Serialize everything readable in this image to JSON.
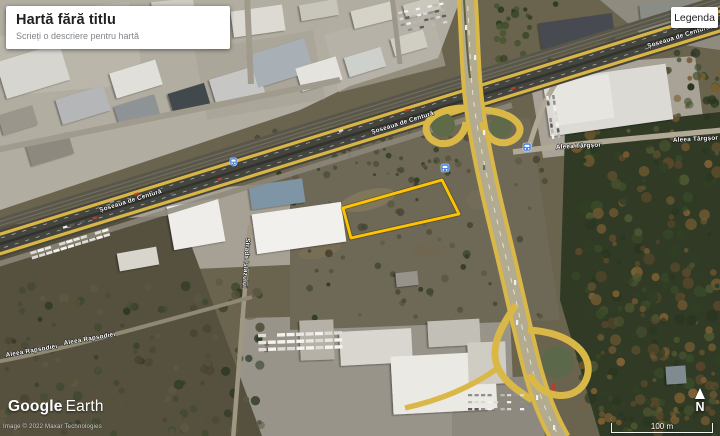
{
  "ui": {
    "map_card": {
      "title": "Hartă fără titlu",
      "subtitle": "Scrieți o descriere pentru hartă"
    },
    "legend_button": {
      "label": "Legenda"
    },
    "branding": {
      "logo_google": "Google",
      "logo_earth": "Earth",
      "attribution": "Image © 2022 Maxar Technologies"
    },
    "scale_bar": {
      "label": "100 m"
    },
    "compass": {
      "label": "N"
    }
  },
  "map": {
    "parcel": {
      "stroke": "#fdc500",
      "points": "343,208 442,180 459,214 351,238"
    },
    "road_labels": [
      {
        "text": "Șoseaua de Centură",
        "x": 100,
        "y": 212,
        "rotate": -17.2
      },
      {
        "text": "Șoseaua de Centură",
        "x": 372,
        "y": 134,
        "rotate": -17.2
      },
      {
        "text": "Șoseaua de Centură",
        "x": 648,
        "y": 48,
        "rotate": -17.2
      },
      {
        "text": "Aleea Târgșor",
        "x": 556,
        "y": 149,
        "rotate": -3
      },
      {
        "text": "Aleea Târgșor",
        "x": 673,
        "y": 142,
        "rotate": -3
      },
      {
        "text": "Aleea Rapsodiei",
        "x": 6,
        "y": 357,
        "rotate": -10
      },
      {
        "text": "Aleea Rapsodiei",
        "x": 64,
        "y": 345,
        "rotate": -10
      },
      {
        "text": "Strada Islazului",
        "x": 246,
        "y": 238,
        "rotate": 94
      }
    ],
    "transit_icons": [
      {
        "x": 230,
        "y": 158,
        "s": 7
      },
      {
        "x": 441,
        "y": 164,
        "s": 8
      },
      {
        "x": 523,
        "y": 143,
        "s": 8
      }
    ]
  }
}
